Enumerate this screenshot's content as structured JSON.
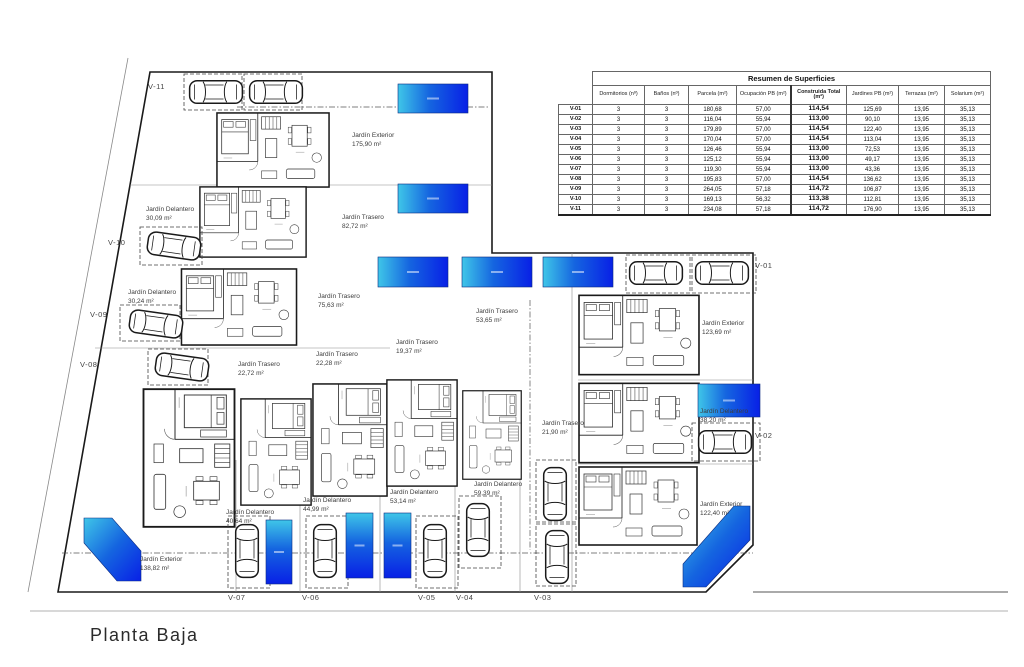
{
  "title": "Planta Baja",
  "table": {
    "title": "Resumen de Superficies",
    "columns": [
      "Dormitorios (nº)",
      "Baños (nº)",
      "Parcela (m²)",
      "Ocupación PB (m²)",
      "Construida Total (m²)",
      "Jardines PB (m²)",
      "Terrazas (m²)",
      "Solarium (m²)"
    ],
    "rows": [
      {
        "id": "V-01",
        "values": [
          "3",
          "3",
          "180,68",
          "57,00",
          "114,54",
          "125,69",
          "13,95",
          "35,13"
        ]
      },
      {
        "id": "V-02",
        "values": [
          "3",
          "3",
          "116,04",
          "55,94",
          "113,00",
          "90,10",
          "13,95",
          "35,13"
        ]
      },
      {
        "id": "V-03",
        "values": [
          "3",
          "3",
          "179,89",
          "57,00",
          "114,54",
          "122,40",
          "13,95",
          "35,13"
        ]
      },
      {
        "id": "V-04",
        "values": [
          "3",
          "3",
          "170,04",
          "57,00",
          "114,54",
          "113,04",
          "13,95",
          "35,13"
        ]
      },
      {
        "id": "V-05",
        "values": [
          "3",
          "3",
          "126,46",
          "55,94",
          "113,00",
          "72,53",
          "13,95",
          "35,13"
        ]
      },
      {
        "id": "V-06",
        "values": [
          "3",
          "3",
          "125,12",
          "55,94",
          "113,00",
          "49,17",
          "13,95",
          "35,13"
        ]
      },
      {
        "id": "V-07",
        "values": [
          "3",
          "3",
          "119,30",
          "55,94",
          "113,00",
          "43,36",
          "13,95",
          "35,13"
        ]
      },
      {
        "id": "V-08",
        "values": [
          "3",
          "3",
          "195,83",
          "57,00",
          "114,54",
          "136,62",
          "13,95",
          "35,13"
        ]
      },
      {
        "id": "V-09",
        "values": [
          "3",
          "3",
          "264,05",
          "57,18",
          "114,72",
          "106,87",
          "13,95",
          "35,13"
        ]
      },
      {
        "id": "V-10",
        "values": [
          "3",
          "3",
          "169,13",
          "56,32",
          "113,38",
          "112,81",
          "13,95",
          "35,13"
        ]
      },
      {
        "id": "V-11",
        "values": [
          "3",
          "3",
          "234,08",
          "57,18",
          "114,72",
          "176,90",
          "13,95",
          "35,13"
        ]
      }
    ]
  },
  "plan": {
    "garden_labels": [
      {
        "name": "Jardín Exterior",
        "area": "175,90 m²"
      },
      {
        "name": "Jardín Trasero",
        "area": "82,72 m²"
      },
      {
        "name": "Jardín Delantero",
        "area": "30,09 m²"
      },
      {
        "name": "Jardín Delantero",
        "area": "30,24 m²"
      },
      {
        "name": "Jardín Trasero",
        "area": "75,63 m²"
      },
      {
        "name": "Jardín Trasero",
        "area": "53,65 m²"
      },
      {
        "name": "Jardín Trasero",
        "area": "19,37 m²"
      },
      {
        "name": "Jardín Trasero",
        "area": "22,72 m²"
      },
      {
        "name": "Jardín Trasero",
        "area": "22,28 m²"
      },
      {
        "name": "Jardín Exterior",
        "area": "123,69 m²"
      },
      {
        "name": "Jardín Delantero",
        "area": "38,20 m²"
      },
      {
        "name": "Jardín Trasero",
        "area": "21,90 m²"
      },
      {
        "name": "Jardín Delantero",
        "area": "40,64 m²"
      },
      {
        "name": "Jardín Delantero",
        "area": "44,99 m²"
      },
      {
        "name": "Jardín Delantero",
        "area": "53,14 m²"
      },
      {
        "name": "Jardín Delantero",
        "area": "59,39 m²"
      },
      {
        "name": "Jardín Exterior",
        "area": "138,82 m²"
      },
      {
        "name": "Jardín Exterior",
        "area": "122,40 m²"
      }
    ],
    "unit_labels": [
      "V-11",
      "V-10",
      "V-09",
      "V-08",
      "V-07",
      "V-06",
      "V-05",
      "V-04",
      "V-03",
      "V-02",
      "V-01"
    ],
    "pool_color_start": "#3fc6e8",
    "pool_color_mid": "#1565e0",
    "pool_color_end": "#0820e6"
  }
}
